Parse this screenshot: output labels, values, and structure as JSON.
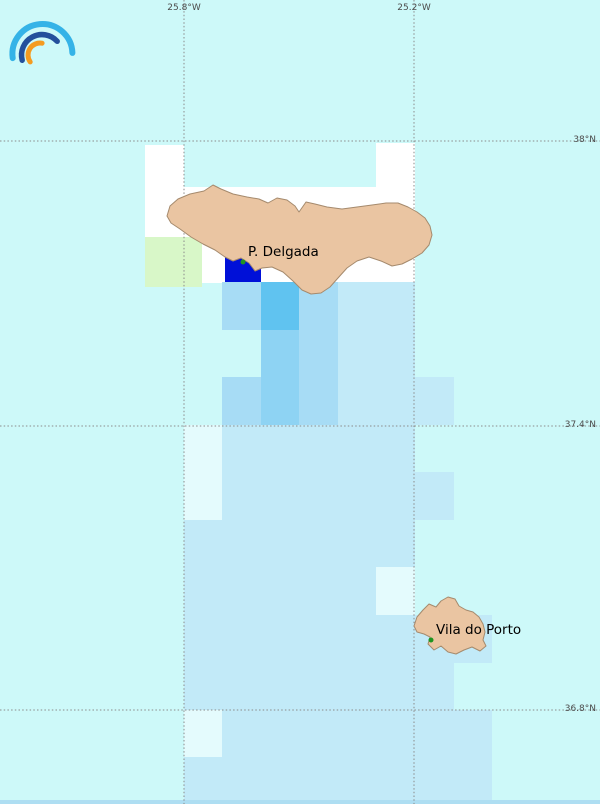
{
  "map": {
    "size": {
      "width": 600,
      "height": 804
    },
    "colors": {
      "sea": "#cdf9f9",
      "no_data": "#ffffff",
      "masked": "#e4fbfd",
      "p1": "#c2eaf8",
      "p2": "#a7dcf5",
      "p3": "#8ed3f3",
      "p4": "#60c3f0",
      "max": "#0010d8",
      "green": "#d8f7c8",
      "land": "#eac5a2",
      "coast": "#a58a6d",
      "grid": "#8a8a8a",
      "grid_label": "#4c4c4c",
      "city_label": "#000000",
      "city_dot": "#1f9420",
      "bottom_strip": "#aedef2"
    },
    "graticule": {
      "meridians": [
        {
          "label": "25.8°W",
          "x": 184
        },
        {
          "label": "25.2°W",
          "x": 414
        }
      ],
      "parallels": [
        {
          "label": "38°N",
          "y": 141
        },
        {
          "label": "37.4°N",
          "y": 426
        },
        {
          "label": "36.8°N",
          "y": 710
        }
      ]
    },
    "cities": [
      {
        "name": "P. Delgada",
        "dot_x": 243,
        "dot_y": 262,
        "label_x": 248,
        "label_y": 244
      },
      {
        "name": "Vila do Porto",
        "dot_x": 431,
        "dot_y": 640,
        "label_x": 436,
        "label_y": 622
      }
    ],
    "islands": [
      {
        "name": "island-sao-miguel",
        "points": [
          [
            167,
            216
          ],
          [
            170,
            206
          ],
          [
            178,
            199
          ],
          [
            190,
            194
          ],
          [
            204,
            191
          ],
          [
            213,
            185
          ],
          [
            221,
            189
          ],
          [
            233,
            194
          ],
          [
            247,
            197
          ],
          [
            259,
            199
          ],
          [
            268,
            203
          ],
          [
            277,
            198
          ],
          [
            287,
            200
          ],
          [
            295,
            206
          ],
          [
            299,
            212
          ],
          [
            306,
            202
          ],
          [
            315,
            204
          ],
          [
            327,
            207
          ],
          [
            342,
            209
          ],
          [
            357,
            207
          ],
          [
            372,
            205
          ],
          [
            386,
            203
          ],
          [
            398,
            203
          ],
          [
            408,
            207
          ],
          [
            417,
            212
          ],
          [
            425,
            218
          ],
          [
            430,
            226
          ],
          [
            432,
            235
          ],
          [
            429,
            245
          ],
          [
            422,
            253
          ],
          [
            412,
            259
          ],
          [
            402,
            264
          ],
          [
            392,
            266
          ],
          [
            381,
            261
          ],
          [
            369,
            257
          ],
          [
            357,
            261
          ],
          [
            347,
            268
          ],
          [
            338,
            278
          ],
          [
            330,
            287
          ],
          [
            321,
            293
          ],
          [
            311,
            294
          ],
          [
            302,
            290
          ],
          [
            293,
            281
          ],
          [
            283,
            272
          ],
          [
            272,
            267
          ],
          [
            262,
            268
          ],
          [
            255,
            271
          ],
          [
            249,
            263
          ],
          [
            241,
            258
          ],
          [
            233,
            261
          ],
          [
            225,
            257
          ],
          [
            215,
            250
          ],
          [
            203,
            244
          ],
          [
            191,
            237
          ],
          [
            180,
            229
          ],
          [
            171,
            223
          ]
        ]
      },
      {
        "name": "island-santa-maria",
        "points": [
          [
            414,
            626
          ],
          [
            417,
            617
          ],
          [
            423,
            610
          ],
          [
            429,
            604
          ],
          [
            436,
            607
          ],
          [
            441,
            601
          ],
          [
            448,
            597
          ],
          [
            455,
            599
          ],
          [
            459,
            606
          ],
          [
            466,
            610
          ],
          [
            473,
            612
          ],
          [
            479,
            617
          ],
          [
            483,
            624
          ],
          [
            485,
            632
          ],
          [
            483,
            640
          ],
          [
            486,
            646
          ],
          [
            480,
            651
          ],
          [
            472,
            647
          ],
          [
            464,
            650
          ],
          [
            456,
            654
          ],
          [
            448,
            652
          ],
          [
            441,
            646
          ],
          [
            434,
            650
          ],
          [
            428,
            644
          ],
          [
            430,
            637
          ],
          [
            424,
            634
          ],
          [
            417,
            632
          ]
        ]
      }
    ],
    "no_data_polygons": [
      [
        [
          145,
          145
        ],
        [
          184,
          145
        ],
        [
          184,
          187
        ],
        [
          376,
          187
        ],
        [
          376,
          143
        ],
        [
          415,
          143
        ],
        [
          415,
          283
        ],
        [
          145,
          283
        ]
      ]
    ],
    "cells": [
      {
        "x": 145,
        "y": 237,
        "w": 57,
        "h": 50,
        "level": "green"
      },
      {
        "x": 225,
        "y": 245,
        "w": 36,
        "h": 41,
        "level": "max"
      },
      {
        "x": 222,
        "y": 282,
        "w": 39,
        "h": 48,
        "level": "p2"
      },
      {
        "x": 261,
        "y": 282,
        "w": 38,
        "h": 48,
        "level": "p4"
      },
      {
        "x": 299,
        "y": 282,
        "w": 39,
        "h": 48,
        "level": "p2"
      },
      {
        "x": 338,
        "y": 282,
        "w": 77,
        "h": 48,
        "level": "p1"
      },
      {
        "x": 261,
        "y": 330,
        "w": 38,
        "h": 48,
        "level": "p3"
      },
      {
        "x": 299,
        "y": 330,
        "w": 39,
        "h": 48,
        "level": "p2"
      },
      {
        "x": 338,
        "y": 330,
        "w": 77,
        "h": 48,
        "level": "p1"
      },
      {
        "x": 222,
        "y": 377,
        "w": 39,
        "h": 48,
        "level": "p2"
      },
      {
        "x": 261,
        "y": 377,
        "w": 38,
        "h": 48,
        "level": "p3"
      },
      {
        "x": 299,
        "y": 377,
        "w": 39,
        "h": 48,
        "level": "p2"
      },
      {
        "x": 338,
        "y": 377,
        "w": 116,
        "h": 48,
        "level": "p1"
      },
      {
        "x": 184,
        "y": 425,
        "w": 38,
        "h": 95,
        "level": "masked"
      },
      {
        "x": 222,
        "y": 425,
        "w": 193,
        "h": 95,
        "level": "p1"
      },
      {
        "x": 415,
        "y": 472,
        "w": 39,
        "h": 48,
        "level": "p1"
      },
      {
        "x": 184,
        "y": 520,
        "w": 231,
        "h": 48,
        "level": "p1"
      },
      {
        "x": 184,
        "y": 567,
        "w": 192,
        "h": 48,
        "level": "p1"
      },
      {
        "x": 376,
        "y": 567,
        "w": 39,
        "h": 48,
        "level": "masked"
      },
      {
        "x": 184,
        "y": 615,
        "w": 308,
        "h": 48,
        "level": "p1"
      },
      {
        "x": 184,
        "y": 662,
        "w": 270,
        "h": 48,
        "level": "p1"
      },
      {
        "x": 184,
        "y": 710,
        "w": 38,
        "h": 48,
        "level": "masked"
      },
      {
        "x": 222,
        "y": 710,
        "w": 270,
        "h": 48,
        "level": "p1"
      },
      {
        "x": 184,
        "y": 757,
        "w": 308,
        "h": 47,
        "level": "p1"
      }
    ],
    "bottom_strip": {
      "x": 0,
      "y": 800,
      "w": 600,
      "h": 4
    },
    "logo": {
      "arc_colors": [
        "#35b3e7",
        "#24509c",
        "#f49b20"
      ]
    }
  }
}
